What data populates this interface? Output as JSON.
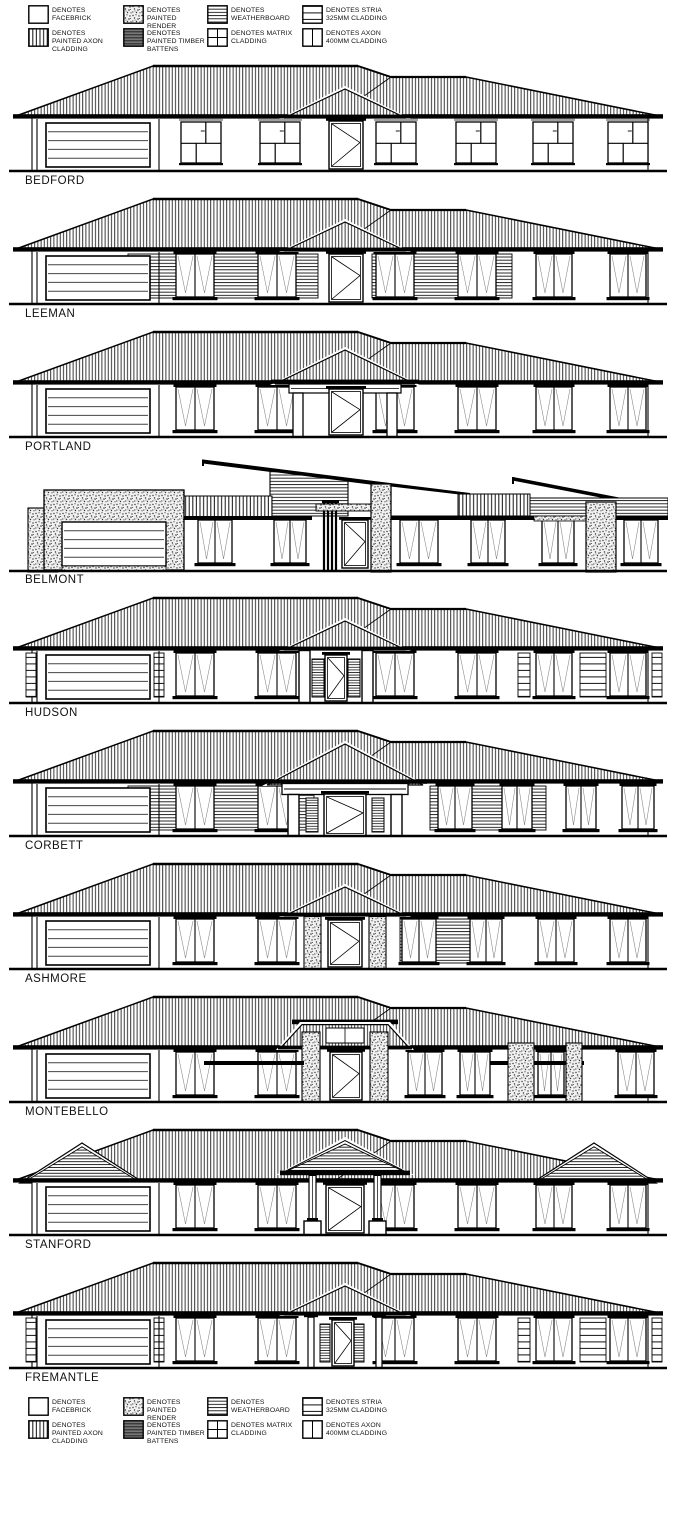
{
  "sheet": {
    "background": "#ffffff",
    "ink": "#000000"
  },
  "legend": {
    "items": [
      {
        "id": "facebrick",
        "label": "DENOTES FACEBRICK",
        "pattern": "plain"
      },
      {
        "id": "painted-axon-cladding",
        "label": "DENOTES PAINTED AXON CLADDING",
        "pattern": "axon"
      },
      {
        "id": "painted-render",
        "label": "DENOTES PAINTED RENDER",
        "pattern": "render"
      },
      {
        "id": "painted-timber-battens",
        "label": "DENOTES PAINTED TIMBER BATTENS",
        "pattern": "battens"
      },
      {
        "id": "weatherboard",
        "label": "DENOTES WEATHERBOARD",
        "pattern": "weatherboard"
      },
      {
        "id": "matrix-cladding",
        "label": "DENOTES MATRIX CLADDING",
        "pattern": "matrix"
      },
      {
        "id": "stria-cladding",
        "label": "DENOTES STRIA 325mm CLADDING",
        "pattern": "stria"
      },
      {
        "id": "axon-400-cladding",
        "label": "DENOTES AXON 400MM CLADDING",
        "pattern": "axon400"
      }
    ]
  },
  "houses": [
    {
      "name": "BEDFORD",
      "roof": "hip",
      "windows": "matrix",
      "portico": "gablet",
      "panels": []
    },
    {
      "name": "LEEMAN",
      "roof": "hip",
      "windows": "tall",
      "portico": "gablet",
      "panels": [
        {
          "x": 120,
          "w": 190,
          "type": "weatherboard"
        },
        {
          "x": 364,
          "w": 140,
          "type": "weatherboard"
        }
      ]
    },
    {
      "name": "PORTLAND",
      "roof": "hip",
      "windows": "tall",
      "portico": "hip-columns",
      "panels": []
    },
    {
      "name": "BELMONT",
      "roof": "skillion",
      "windows": "tall",
      "portico": "battens-render-piers",
      "panels": []
    },
    {
      "name": "HUDSON",
      "roof": "hip",
      "windows": "tall",
      "portico": "columns-sidelights",
      "panels": [
        {
          "x": 18,
          "w": 10,
          "type": "stria"
        },
        {
          "x": 146,
          "w": 10,
          "type": "stria"
        },
        {
          "x": 510,
          "w": 12,
          "type": "stria"
        },
        {
          "x": 572,
          "w": 26,
          "type": "stria"
        },
        {
          "x": 644,
          "w": 10,
          "type": "stria"
        }
      ]
    },
    {
      "name": "CORBETT",
      "roof": "hip",
      "windows": "tall",
      "portico": "entablature-columns",
      "panels": [
        {
          "x": 120,
          "w": 186,
          "type": "weatherboard"
        },
        {
          "x": 422,
          "w": 116,
          "type": "weatherboard"
        }
      ],
      "window_layout": [
        [
          168,
          38
        ],
        [
          250,
          38
        ],
        [
          430,
          34
        ],
        [
          494,
          30
        ],
        [
          558,
          30
        ],
        [
          614,
          32
        ]
      ]
    },
    {
      "name": "ASHMORE",
      "roof": "hip",
      "windows": "tall",
      "portico": "render-piers",
      "panels": [
        {
          "x": 392,
          "w": 72,
          "type": "weatherboard"
        }
      ],
      "window_layout": [
        [
          168,
          38
        ],
        [
          250,
          38
        ],
        [
          394,
          34
        ],
        [
          462,
          32
        ],
        [
          530,
          36
        ],
        [
          602,
          36
        ]
      ]
    },
    {
      "name": "MONTEBELLO",
      "roof": "hip",
      "windows": "tall",
      "portico": "montebello",
      "panels": [],
      "window_layout": [
        [
          168,
          38
        ],
        [
          250,
          38
        ],
        [
          400,
          34
        ],
        [
          452,
          30
        ],
        [
          530,
          26
        ],
        [
          610,
          36
        ]
      ]
    },
    {
      "name": "STANFORD",
      "roof": "hip",
      "windows": "tall",
      "portico": "pediment-columns",
      "panels": [],
      "gable_ends": true
    },
    {
      "name": "FREMANTLE",
      "roof": "hip",
      "windows": "tall",
      "portico": "slim-columns",
      "panels": [
        {
          "x": 18,
          "w": 10,
          "type": "stria"
        },
        {
          "x": 146,
          "w": 10,
          "type": "stria"
        },
        {
          "x": 510,
          "w": 12,
          "type": "stria"
        },
        {
          "x": 572,
          "w": 26,
          "type": "stria"
        },
        {
          "x": 644,
          "w": 10,
          "type": "stria"
        }
      ]
    }
  ]
}
